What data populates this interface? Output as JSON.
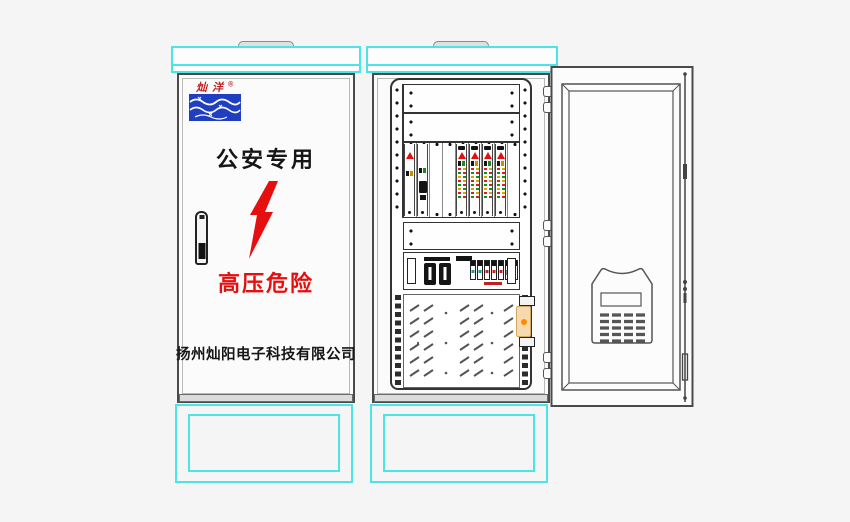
{
  "page": {
    "background_color": "#f4f5f4"
  },
  "palette": {
    "outline": "#4a4a4a",
    "cyan_accent": "#4ce4e4",
    "warning_red": "#e60f0f",
    "logo_blue": "#1f3fc0",
    "clamp_orange": "#ff8a00",
    "clamp_tan": "#f6d9ae"
  },
  "closed_cabinet": {
    "logo": {
      "brand": "灿洋",
      "registered_mark": "®",
      "icon": "wave-logo-icon"
    },
    "front_label": "公安专用",
    "lightning_icon": "high-voltage-lightning-icon",
    "handle_icon": "swing-handle-lock-icon",
    "warning_label": "高压危险",
    "company_name": "扬州灿阳电子科技有限公司"
  },
  "open_cabinet": {
    "rack": {
      "blank_panels_top": 2,
      "card_slots": 9,
      "cards_installed": 6,
      "blank_panel_middle": 1
    },
    "icons": {
      "power_switch": "isolator-switch-icon",
      "breakers": "circuit-breaker-row-icon",
      "vent_panel": "louver-vent-panel",
      "cable_clamp": "orange-cable-clamp-icon"
    }
  },
  "open_door": {
    "icons": {
      "hinges": "door-hinge-icon",
      "lock_rod": "door-lock-rod-icon",
      "filter_housing": "air-filter-housing-icon",
      "display_window": "display-window",
      "vent_grid": "vent-grid-icon"
    }
  }
}
